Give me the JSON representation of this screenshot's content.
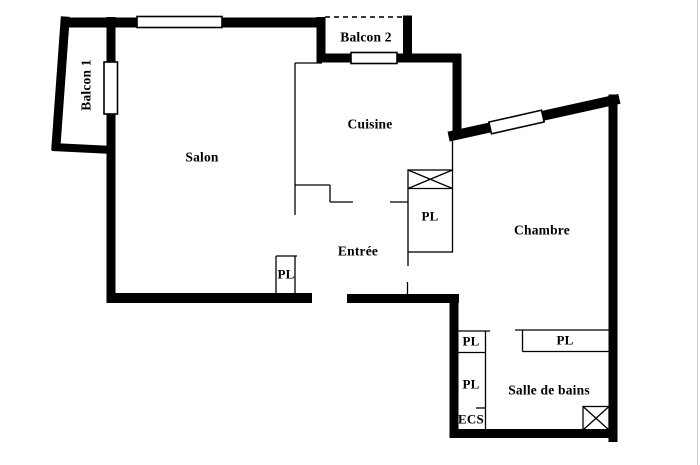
{
  "rooms": {
    "balcon1": "Balcon 1",
    "balcon2": "Balcon 2",
    "salon": "Salon",
    "cuisine": "Cuisine",
    "entree": "Entrée",
    "chambre": "Chambre",
    "salle_de_bains": "Salle de bains"
  },
  "closets": {
    "pl": "PL",
    "ecs": "ECS"
  },
  "colors": {
    "wall": "#000000",
    "background": "#ffffff",
    "window_fill": "#ffffff",
    "edge_line": "#cfcfcf"
  }
}
